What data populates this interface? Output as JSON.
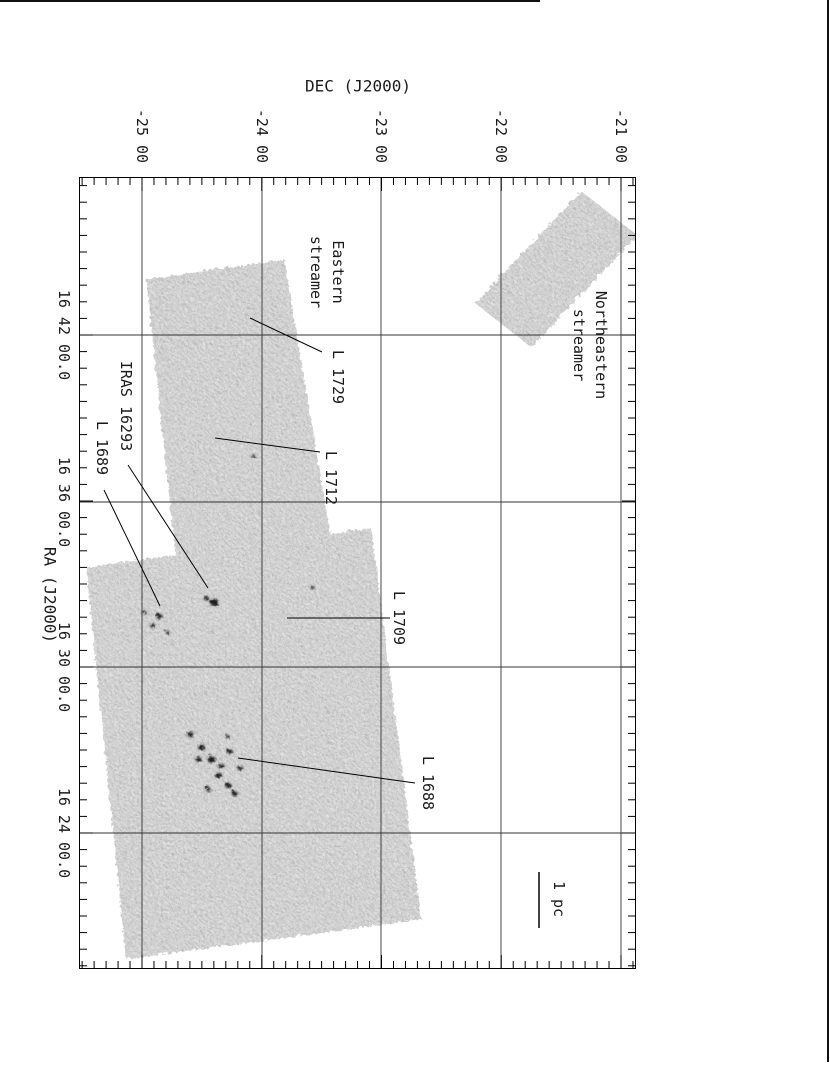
{
  "figure": {
    "background": "#ffffff",
    "text_color": "#1a1a1a",
    "map_base_gray": "#d4d4d4",
    "line_color": "#000000"
  },
  "chart_data": {
    "type": "heatmap",
    "title": "",
    "xlabel": "DEC (J2000)",
    "ylabel": "RA (J2000)",
    "x_ticks": [
      "-25 00",
      "-24 00",
      "-23 00",
      "-22 00",
      "-21 00"
    ],
    "y_ticks": [
      "16 42 00.0",
      "16 36 00.0",
      "16 30 00.0",
      "16 24 00.0"
    ],
    "grid": true,
    "x_axis_position": "top",
    "y_axis_position": "left",
    "layout": {
      "plot": {
        "left": 79,
        "top": 177,
        "width": 557,
        "height": 792
      },
      "x_grid_page": [
        142,
        262,
        381,
        501,
        621
      ],
      "y_grid_page": [
        335,
        502,
        667,
        833
      ],
      "x_tick_label_y": 136,
      "y_tick_label_x": 64,
      "minor_per_major": 10,
      "minor_tick_len": 7,
      "major_tick_len": 13
    },
    "regions": [
      {
        "id": "northeastern-streamer-field",
        "points": [
          [
            474,
            302
          ],
          [
            580,
            190
          ],
          [
            636,
            234
          ],
          [
            530,
            346
          ]
        ]
      },
      {
        "id": "eastern-streamer-field",
        "points": [
          [
            145,
            278
          ],
          [
            283,
            258
          ],
          [
            330,
            540
          ],
          [
            175,
            560
          ]
        ]
      },
      {
        "id": "l1688-l1689-field",
        "points": [
          [
            85,
            566
          ],
          [
            370,
            527
          ],
          [
            420,
            918
          ],
          [
            125,
            958
          ]
        ]
      }
    ],
    "dense_cores": [
      [
        213,
        601,
        4.5
      ],
      [
        205,
        597,
        2.5
      ],
      [
        158,
        615,
        3
      ],
      [
        151,
        624,
        2.5
      ],
      [
        166,
        631,
        2
      ],
      [
        143,
        611,
        2
      ],
      [
        189,
        733,
        3
      ],
      [
        200,
        746,
        3.5
      ],
      [
        197,
        758,
        3
      ],
      [
        210,
        758,
        4
      ],
      [
        220,
        765,
        3
      ],
      [
        228,
        750,
        3
      ],
      [
        217,
        774,
        3.5
      ],
      [
        227,
        784,
        3
      ],
      [
        233,
        792,
        3
      ],
      [
        207,
        788,
        2.5
      ],
      [
        239,
        767,
        2.5
      ],
      [
        226,
        735,
        2
      ],
      [
        311,
        586,
        1.8
      ],
      [
        252,
        455,
        1.8
      ]
    ],
    "annotations": [
      {
        "id": "northeastern-streamer",
        "label": "Northeastern\nstreamer",
        "x": 590,
        "y": 345
      },
      {
        "id": "eastern-streamer",
        "label": "Eastern\nstreamer",
        "x": 327,
        "y": 272
      },
      {
        "id": "l-1729",
        "label": "L 1729",
        "x": 338,
        "y": 377,
        "line": [
          250,
          318,
          322,
          352
        ]
      },
      {
        "id": "l-1712",
        "label": "L 1712",
        "x": 331,
        "y": 478,
        "line": [
          215,
          438,
          320,
          452
        ]
      },
      {
        "id": "iras-16293",
        "label": "IRAS 16293",
        "x": 126,
        "y": 406,
        "line": [
          128,
          465,
          208,
          588
        ]
      },
      {
        "id": "l-1689",
        "label": "L 1689",
        "x": 102,
        "y": 448,
        "line": [
          104,
          490,
          160,
          606
        ]
      },
      {
        "id": "l-1709",
        "label": "L 1709",
        "x": 399,
        "y": 618,
        "line": [
          287,
          618,
          390,
          618
        ]
      },
      {
        "id": "l-1688",
        "label": "L 1688",
        "x": 428,
        "y": 783,
        "line": [
          238,
          758,
          415,
          783
        ]
      }
    ],
    "scale_bar": {
      "label": "1 pc",
      "bar_x": 539,
      "bar_y1": 872,
      "bar_y2": 928,
      "label_x": 559,
      "label_y": 899
    }
  }
}
